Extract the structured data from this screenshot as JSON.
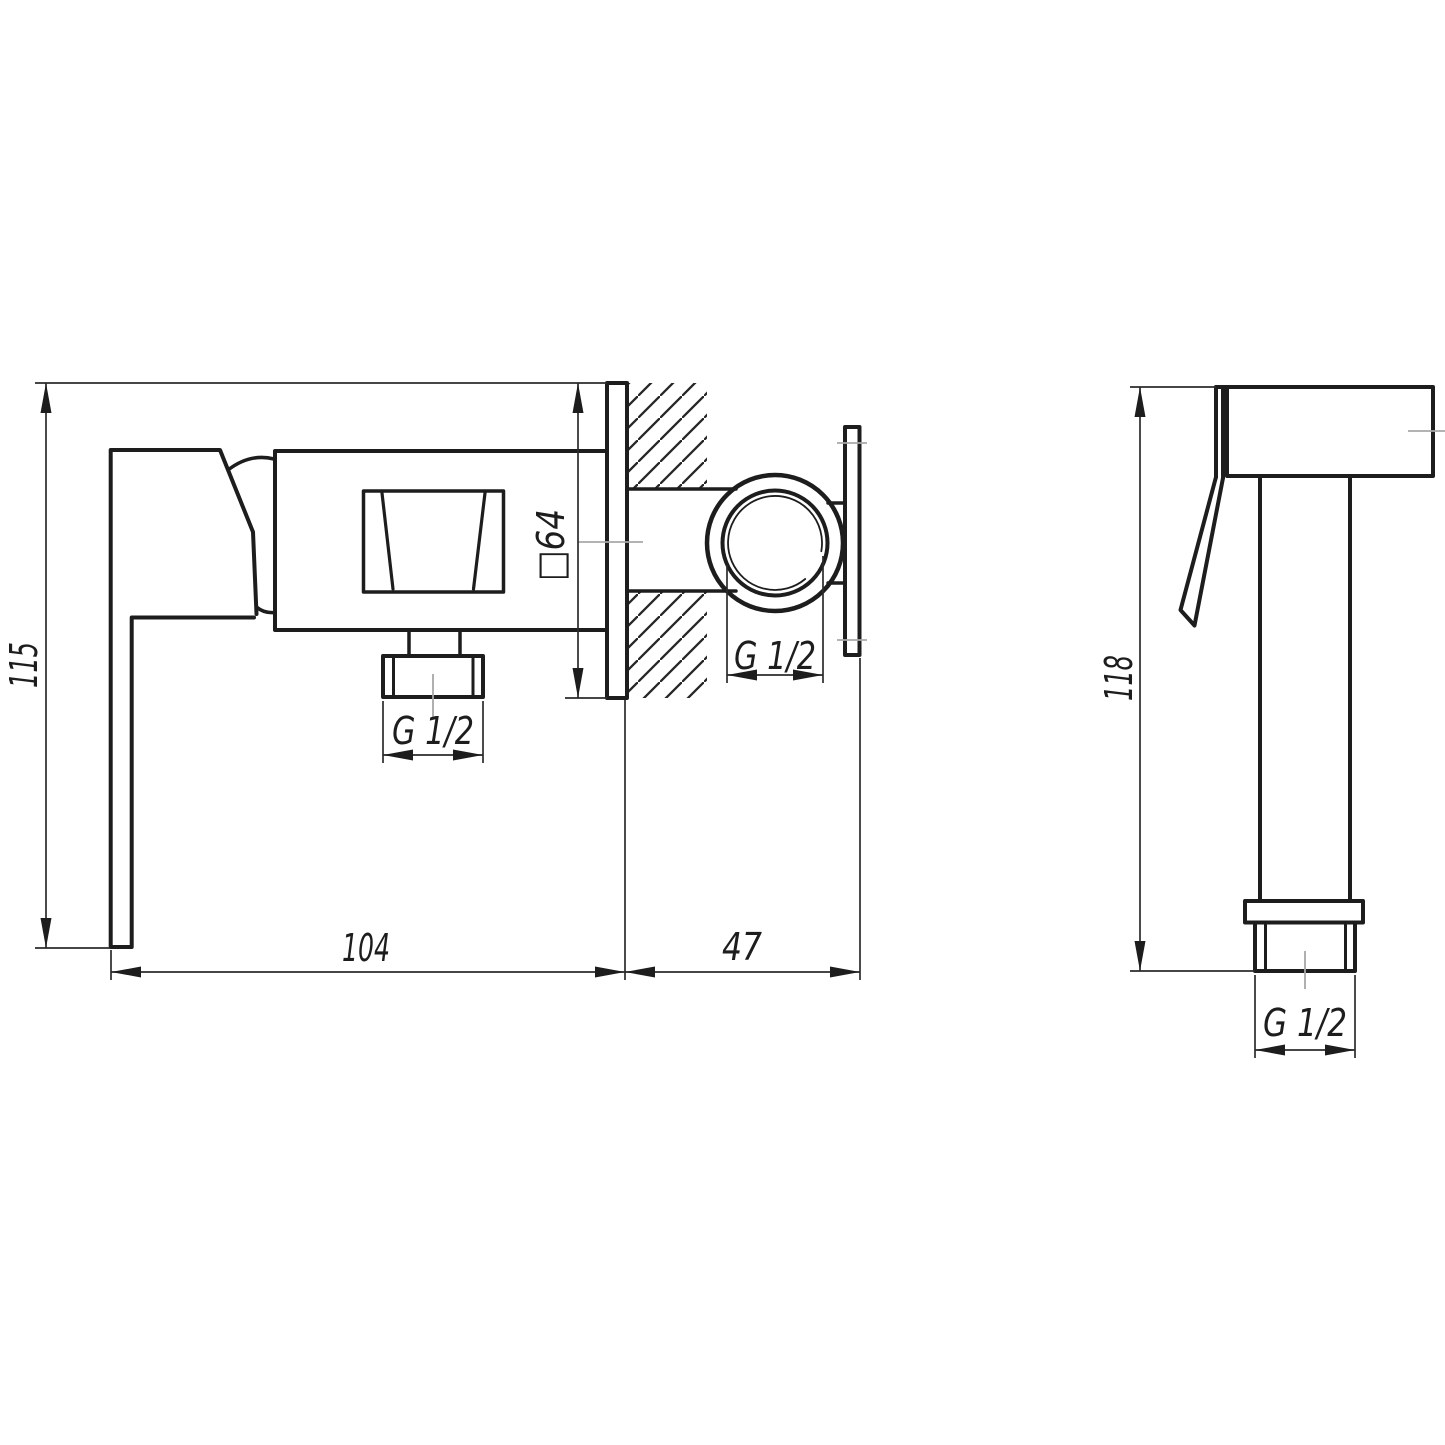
{
  "drawing": {
    "background": "#ffffff",
    "line_color": "#1d1d1d",
    "thin_line_color": "#2b2b2b",
    "centerline_color": "#a8a8a8",
    "front_view": {
      "dim_height": "115",
      "dim_plate_square": "□64",
      "dim_length": "104",
      "dim_wall_offset": "47",
      "dim_outlet_thread": "G 1/2",
      "dim_inlet_thread": "G 1/2"
    },
    "sprayer_view": {
      "dim_height": "118",
      "dim_thread": "G 1/2"
    }
  }
}
